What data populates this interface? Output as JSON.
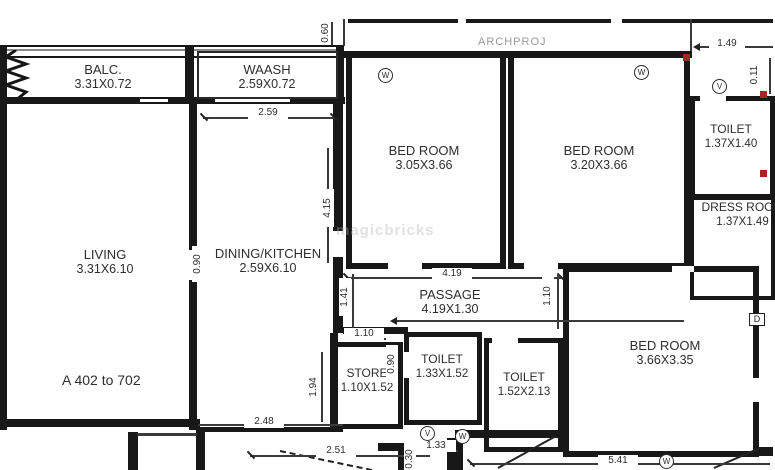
{
  "header": {
    "label": "ARCHPROJ"
  },
  "watermark": {
    "text": "magicbricks"
  },
  "unit": {
    "label": "A 402 to 702"
  },
  "rooms": [
    {
      "name": "BALC.",
      "dims": "3.31X0.72"
    },
    {
      "name": "WAASH",
      "dims": "2.59X0.72"
    },
    {
      "name": "LIVING",
      "dims": "3.31X6.10"
    },
    {
      "name": "DINING/KITCHEN",
      "dims": "2.59X6.10"
    },
    {
      "name": "BED ROOM",
      "dims": "3.05X3.66"
    },
    {
      "name": "BED ROOM",
      "dims": "3.20X3.66"
    },
    {
      "name": "TOILET",
      "dims": "1.37X1.40"
    },
    {
      "name": "DRESS ROOM",
      "dims": "1.37X1.49"
    },
    {
      "name": "PASSAGE",
      "dims": "4.19X1.30"
    },
    {
      "name": "STORE",
      "dims": "1.10X1.52"
    },
    {
      "name": "TOILET",
      "dims": "1.33X1.52"
    },
    {
      "name": "TOILET",
      "dims": "1.52X2.13"
    },
    {
      "name": "BED ROOM",
      "dims": "3.66X3.35"
    }
  ],
  "dimensions": [
    {
      "value": "1.49"
    },
    {
      "value": "0.60"
    },
    {
      "value": "0.11"
    },
    {
      "value": "2.59"
    },
    {
      "value": "4.15"
    },
    {
      "value": "1.41"
    },
    {
      "value": "4.19"
    },
    {
      "value": "1.10"
    },
    {
      "value": "1.10"
    },
    {
      "value": "1.94"
    },
    {
      "value": "2.48"
    },
    {
      "value": "2.51"
    },
    {
      "value": "1.33"
    },
    {
      "value": "0.30"
    },
    {
      "value": "0.90"
    },
    {
      "value": "5.41"
    },
    {
      "value": "0.90"
    }
  ],
  "symbols": {
    "window_tag": "W",
    "vent_tag": "V",
    "door_tag": "D"
  },
  "colors": {
    "wall": "#181818",
    "text": "#2e2e2e",
    "accent_red": "#a82424",
    "header_gray": "#9a9a9a",
    "watermark_gray": "#afafaf"
  }
}
